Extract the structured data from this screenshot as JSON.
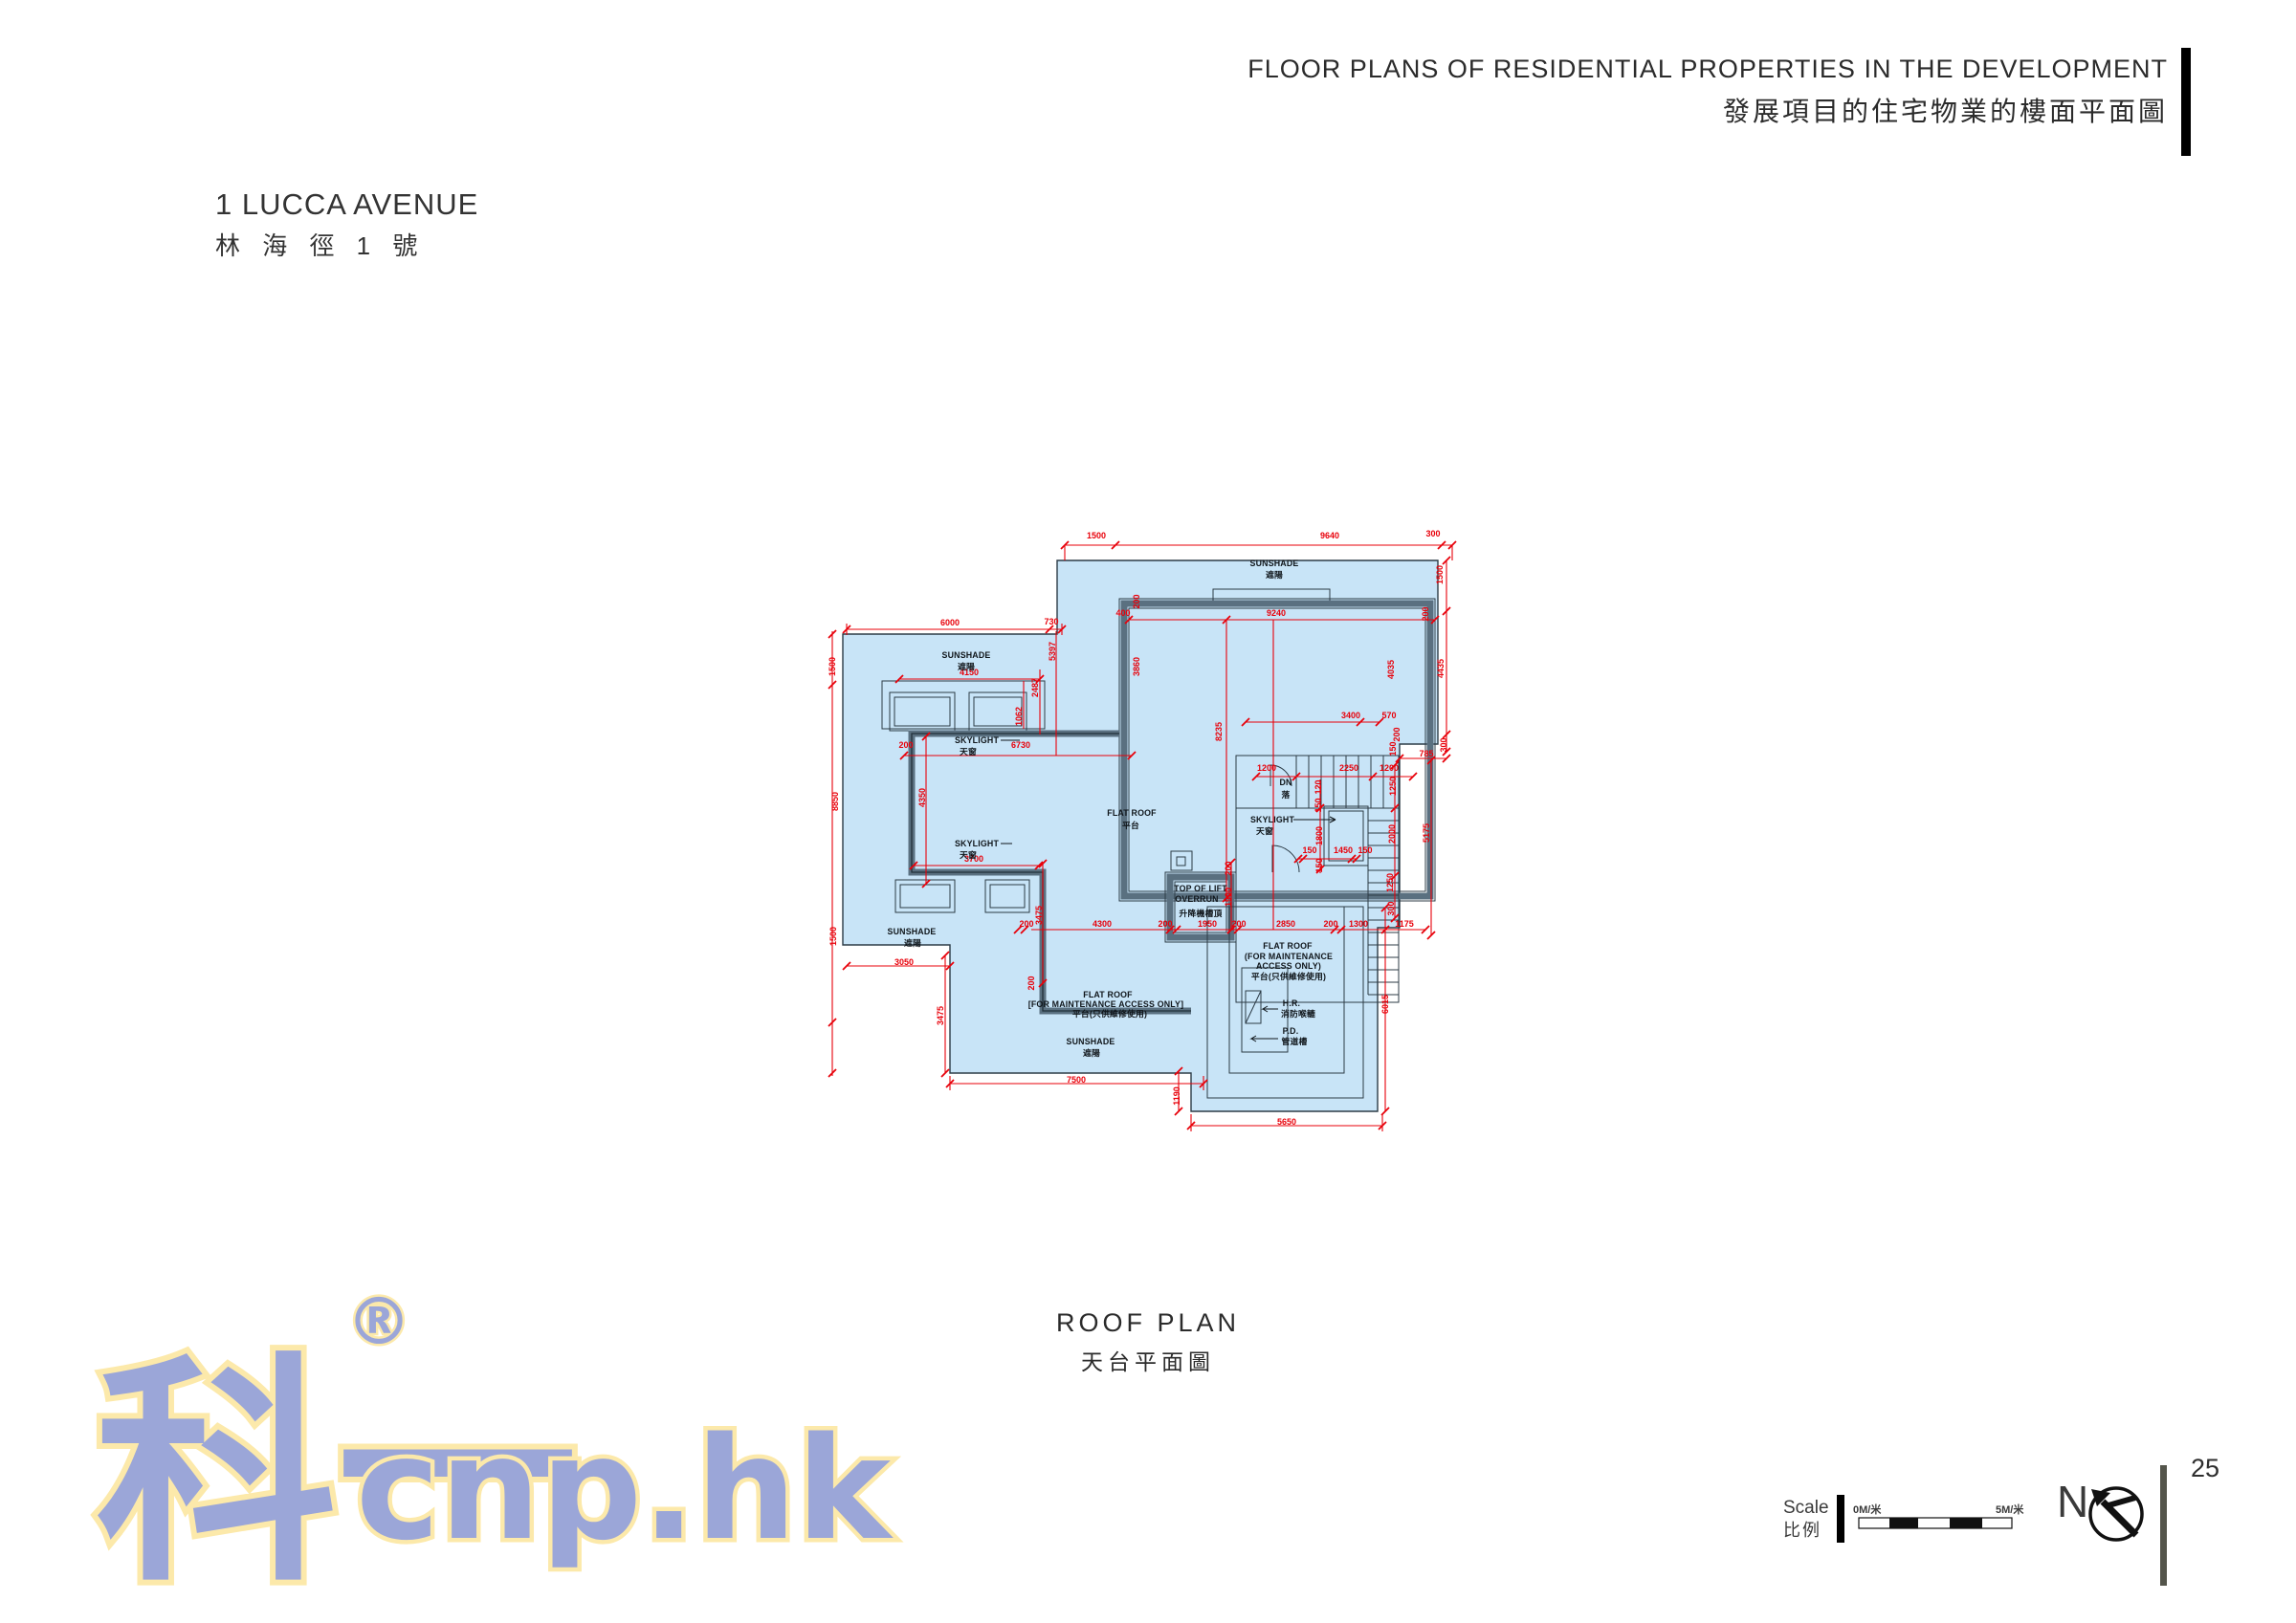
{
  "header": {
    "title_en": "FLOOR PLANS OF RESIDENTIAL PROPERTIES IN THE DEVELOPMENT",
    "title_zh": "發展項目的住宅物業的樓面平面圖"
  },
  "property": {
    "name_en": "1 LUCCA AVENUE",
    "name_zh": "林 海 徑 1 號"
  },
  "plan": {
    "caption_en": "ROOF PLAN",
    "caption_zh": "天台平面圖",
    "colors": {
      "fill": "#c8e4f7",
      "wall": "#5a7080",
      "outline": "#2c3b46",
      "dim": "#e8000a"
    },
    "labels": [
      [
        "SUNSHADE",
        1332,
        592
      ],
      [
        "遮陽",
        1332,
        604
      ],
      [
        "SUNSHADE",
        1010,
        688
      ],
      [
        "遮陽",
        1010,
        700
      ],
      [
        "SKYLIGHT",
        1021,
        777
      ],
      [
        "天窗",
        1012,
        789
      ],
      [
        "FLAT ROOF",
        1183,
        853
      ],
      [
        "平台",
        1182,
        866
      ],
      [
        "SKYLIGHT",
        1021,
        885
      ],
      [
        "天窗",
        1012,
        897
      ],
      [
        "SUNSHADE",
        953,
        977
      ],
      [
        "遮陽",
        954,
        989
      ],
      [
        "DN",
        1344,
        821
      ],
      [
        "落",
        1344,
        834
      ],
      [
        "SKYLIGHT",
        1330,
        860
      ],
      [
        "天窗",
        1322,
        872
      ],
      [
        "TOP OF LIFT",
        1255,
        932
      ],
      [
        "OVERRUN",
        1251,
        943
      ],
      [
        "升降機槽頂",
        1255,
        958
      ],
      [
        "FLAT ROOF",
        1346,
        992
      ],
      [
        "(FOR MAINTENANCE",
        1347,
        1003
      ],
      [
        "ACCESS ONLY)",
        1347,
        1013
      ],
      [
        "平台(只供維修使用)",
        1347,
        1024
      ],
      [
        "FLAT ROOF",
        1158,
        1043
      ],
      [
        "[FOR MAINTENANCE ACCESS ONLY]",
        1156,
        1053
      ],
      [
        "平台(只供維修使用)",
        1160,
        1063
      ],
      [
        "SUNSHADE",
        1140,
        1092
      ],
      [
        "遮陽",
        1141,
        1104
      ],
      [
        "H.R.",
        1350,
        1052
      ],
      [
        "消防喉轆",
        1357,
        1063
      ],
      [
        "P.D.",
        1349,
        1081
      ],
      [
        "管道槽",
        1353,
        1092
      ]
    ],
    "dims": [
      [
        "1500",
        1146,
        563,
        0
      ],
      [
        "9640",
        1390,
        563,
        0
      ],
      [
        "300",
        1498,
        561,
        0
      ],
      [
        "6000",
        993,
        654,
        0
      ],
      [
        "730",
        1099,
        653,
        0
      ],
      [
        "5397",
        1103,
        681,
        1
      ],
      [
        "2487",
        1085,
        719,
        1
      ],
      [
        "1062",
        1068,
        749,
        1
      ],
      [
        "4150",
        1013,
        706,
        0
      ],
      [
        "400",
        1174,
        644,
        0
      ],
      [
        "200",
        1191,
        629,
        1
      ],
      [
        "9240",
        1334,
        644,
        0
      ],
      [
        "200",
        1493,
        642,
        1
      ],
      [
        "1500",
        1508,
        601,
        1
      ],
      [
        "4435",
        1509,
        699,
        1
      ],
      [
        "300",
        1512,
        779,
        1
      ],
      [
        "3860",
        1191,
        697,
        1
      ],
      [
        "4035",
        1457,
        700,
        1
      ],
      [
        "8235",
        1277,
        765,
        1
      ],
      [
        "200",
        947,
        782,
        0
      ],
      [
        "6730",
        1067,
        782,
        0
      ],
      [
        "4350",
        967,
        834,
        1
      ],
      [
        "3700",
        1018,
        901,
        0
      ],
      [
        "1500",
        873,
        697,
        1
      ],
      [
        "8850",
        876,
        838,
        1
      ],
      [
        "1500",
        874,
        979,
        1
      ],
      [
        "3050",
        945,
        1009,
        0
      ],
      [
        "3475",
        1089,
        957,
        1
      ],
      [
        "200",
        1073,
        969,
        0
      ],
      [
        "4300",
        1152,
        969,
        0
      ],
      [
        "200",
        1218,
        969,
        0
      ],
      [
        "1950",
        1262,
        969,
        0
      ],
      [
        "200",
        1295,
        969,
        0
      ],
      [
        "2850",
        1344,
        969,
        0
      ],
      [
        "200",
        1391,
        969,
        0
      ],
      [
        "1300",
        1420,
        969,
        0
      ],
      [
        "1175",
        1468,
        969,
        0
      ],
      [
        "200",
        1081,
        1028,
        1
      ],
      [
        "3475",
        986,
        1062,
        1
      ],
      [
        "7500",
        1125,
        1132,
        0
      ],
      [
        "3400",
        1412,
        751,
        0
      ],
      [
        "570",
        1452,
        751,
        0
      ],
      [
        "200",
        1463,
        768,
        1
      ],
      [
        "150",
        1459,
        783,
        1
      ],
      [
        "785",
        1491,
        791,
        0
      ],
      [
        "5175",
        1494,
        871,
        1
      ],
      [
        "1200",
        1324,
        806,
        0
      ],
      [
        "2250",
        1410,
        806,
        0
      ],
      [
        "1200",
        1452,
        806,
        0
      ],
      [
        "1250",
        1459,
        822,
        1
      ],
      [
        "120",
        1381,
        823,
        1
      ],
      [
        "150",
        1381,
        842,
        1
      ],
      [
        "1800",
        1382,
        874,
        1
      ],
      [
        "150",
        1382,
        905,
        1
      ],
      [
        "150",
        1369,
        892,
        0
      ],
      [
        "1450",
        1404,
        892,
        0
      ],
      [
        "150",
        1427,
        892,
        0
      ],
      [
        "2000",
        1458,
        872,
        1
      ],
      [
        "1250",
        1456,
        923,
        1
      ],
      [
        "300",
        1457,
        950,
        1
      ],
      [
        "1900",
        1287,
        938,
        1
      ],
      [
        "200",
        1287,
        908,
        1
      ],
      [
        "6015",
        1451,
        1050,
        1
      ],
      [
        "1190",
        1233,
        1146,
        1
      ],
      [
        "5650",
        1345,
        1176,
        0
      ]
    ]
  },
  "watermark": {
    "cjk": "科一",
    "reg": "®",
    "domain": "cnp.hk",
    "text_color": "#9ba6d8",
    "outline_color": "#fce9aa"
  },
  "footer": {
    "scale_en": "Scale",
    "scale_zh": "比例",
    "scale_start": "0M/米",
    "scale_end": "5M/米",
    "north": "N",
    "page": "25"
  }
}
